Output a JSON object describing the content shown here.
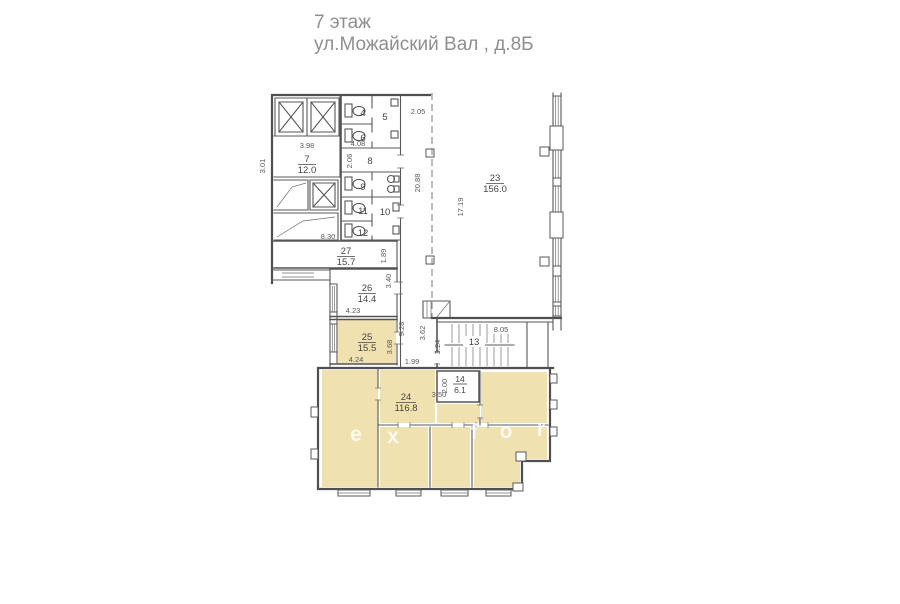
{
  "title": {
    "line1": "7 этаж",
    "line2": "ул.Можайский Вал , д.8Б"
  },
  "rooms": {
    "r4": {
      "num": "4"
    },
    "r5": {
      "num": "5"
    },
    "r6": {
      "num": "6"
    },
    "r7": {
      "num": "7",
      "area": "12.0"
    },
    "r8": {
      "num": "8"
    },
    "r9": {
      "num": "9"
    },
    "r10": {
      "num": "10"
    },
    "r11": {
      "num": "11"
    },
    "r12": {
      "num": "12"
    },
    "r13": {
      "num": "13"
    },
    "r14": {
      "num": "14",
      "area": "6.1"
    },
    "r23": {
      "num": "23",
      "area": "156.0"
    },
    "r24": {
      "num": "24",
      "area": "116.8"
    },
    "r25": {
      "num": "25",
      "area": "15.5"
    },
    "r26": {
      "num": "26",
      "area": "14.4"
    },
    "r27": {
      "num": "27",
      "area": "15.7"
    }
  },
  "dimensions": {
    "core_width": "3.98",
    "core_left": "3.01",
    "corridor_top": "2.05",
    "wc_width": "4.08",
    "room8_depth": "2.06",
    "corridor_len": "20.88",
    "room23_len": "17.19",
    "room27_width": "8.30",
    "room27_right": "1.89",
    "room26_right": "3.40",
    "room26_width": "4.23",
    "corridor_low": "9.28",
    "room25_right": "3.68",
    "room25_width": "4.24",
    "hall_gap": "1.99",
    "stair_left": "3.62",
    "stair_depth": "3.24",
    "stair_width": "8.05",
    "room14_depth": "2.00",
    "room14_width": "3.50"
  },
  "watermark": {
    "l1": "e",
    "l2": "x",
    "l3": "f",
    "l4": "o",
    "l5": "r"
  },
  "colors": {
    "room_fill": "#f0e1b0",
    "line": "#585858",
    "title_text": "#8f8f8f"
  }
}
